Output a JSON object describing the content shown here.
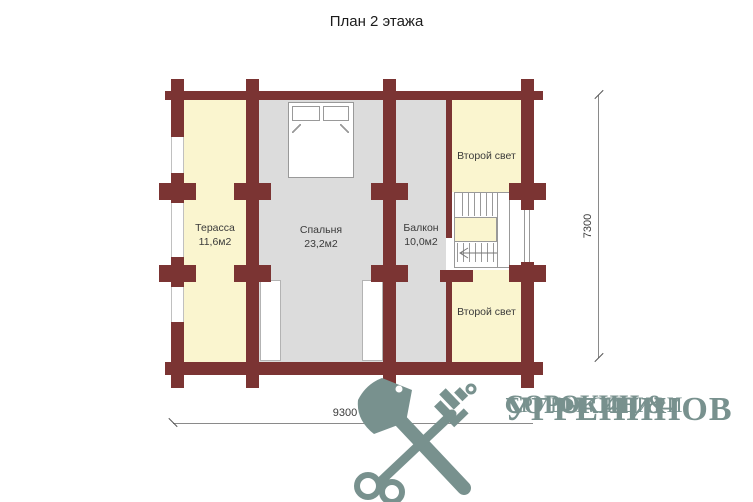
{
  "title": "План 2 этажа",
  "rooms": {
    "terrace": {
      "label": "Терасса",
      "area": "11,6м2"
    },
    "bedroom": {
      "label": "Спальня",
      "area": "23,2м2"
    },
    "balcony": {
      "label": "Балкон",
      "area": "10,0м2"
    },
    "second_light_top": {
      "label": "Второй свет"
    },
    "second_light_bottom": {
      "label": "Второй свет"
    }
  },
  "dimensions": {
    "vertical": "7300",
    "horizontal": "9300"
  },
  "logo": {
    "name_line1": "СОРОКИН &",
    "name_line2": "УГРЕНИНОВ",
    "tagline": "СРУБЫ СИБИРИ"
  },
  "colors": {
    "wall": "#7b3433",
    "cream": "#faf5cf",
    "gray": "#dcdcdc",
    "outline": "#999999",
    "dim": "#8a8a8a",
    "text": "#3a3a3a",
    "logo": "#78918e",
    "title": "#1c1c1c"
  }
}
